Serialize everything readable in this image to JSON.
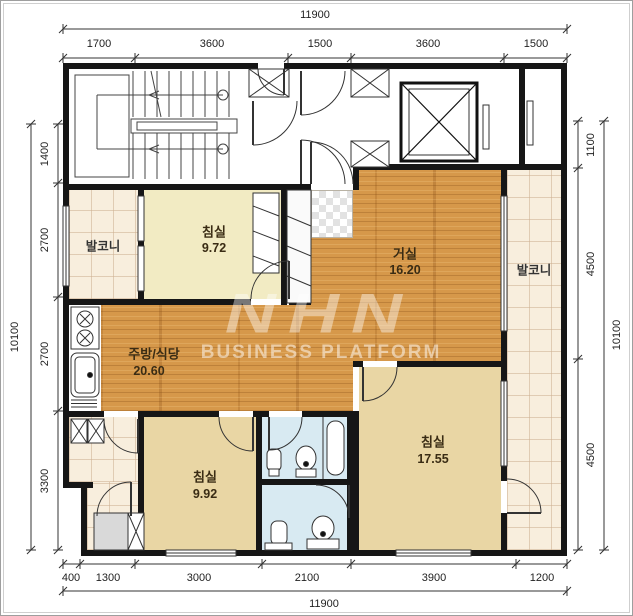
{
  "plan": {
    "watermark": {
      "logo": "NHN",
      "subtitle": "BUSINESS PLATFORM"
    },
    "rooms": {
      "bedroom_top": {
        "name": "침실",
        "area": "9.72"
      },
      "living": {
        "name": "거실",
        "area": "16.20"
      },
      "kitchen": {
        "name": "주방/식당",
        "area": "20.60"
      },
      "bedroom_bottom": {
        "name": "침실",
        "area": "9.92"
      },
      "bedroom_right": {
        "name": "침실",
        "area": "17.55"
      },
      "balcony_left": {
        "name": "발코니"
      },
      "balcony_right": {
        "name": "발코니"
      }
    },
    "dimensions": {
      "top": {
        "total": "11900",
        "segments": [
          "1700",
          "3600",
          "1500",
          "3600",
          "1500"
        ]
      },
      "bottom": {
        "total": "11900",
        "segments": [
          "400",
          "1300",
          "3000",
          "2100",
          "3900",
          "1200"
        ]
      },
      "left": {
        "total": "10100",
        "segments": [
          "1400",
          "2700",
          "2700",
          "3300"
        ]
      },
      "right": {
        "total": "10100",
        "segments": [
          "1100",
          "4500",
          "4500"
        ]
      }
    },
    "colors": {
      "wall": "#161616",
      "wood_floor": "#d6984a",
      "bedroom_top_fill": "#f2ebc3",
      "bedroom_fill": "#e9d6a4",
      "balcony_fill": "#f8eedd",
      "bathroom_fill": "#d8eaf2",
      "hall_fill": "#ffffff"
    }
  }
}
